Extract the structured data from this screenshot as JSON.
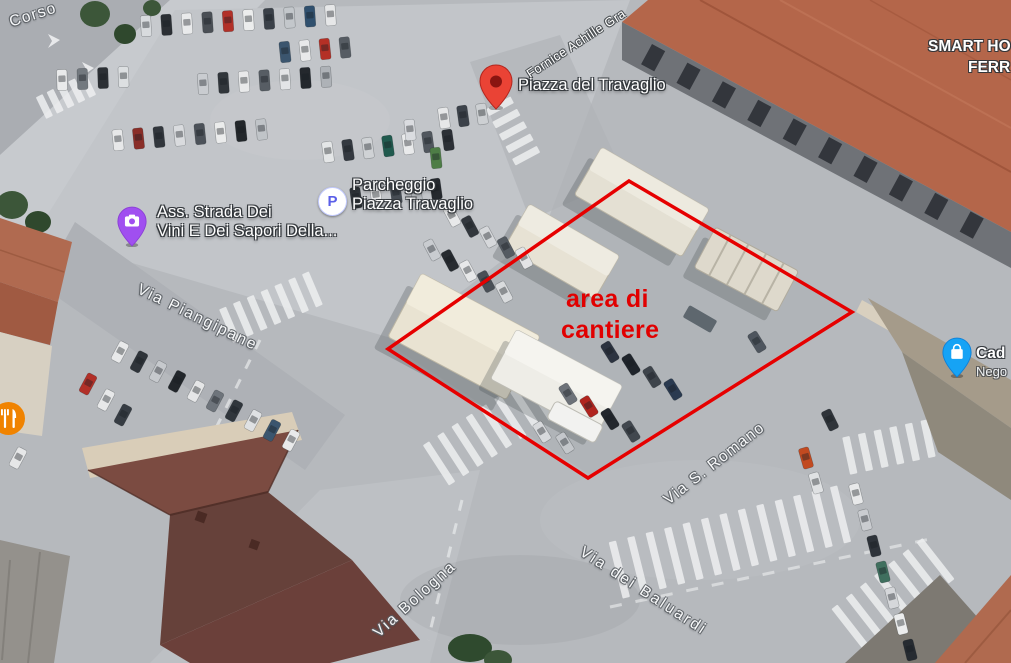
{
  "map_labels": {
    "piazza": {
      "name": "Piazza del Travaglio"
    },
    "parking": {
      "icon_letter": "P",
      "line1": "Parcheggio",
      "line2": "Piazza Travaglio"
    },
    "association": {
      "line1": "Ass. Strada Dei",
      "line2": "Vini E Dei Sapori Della..."
    },
    "hotel": {
      "line1": "SMART HO",
      "line2": "FERR"
    },
    "shop": {
      "line1": "Cad",
      "line2": "Nego"
    },
    "building_sign": "Fornice Achille Gra"
  },
  "street_labels": {
    "corso": "Corso",
    "piangipane": "Via Piangipane",
    "bologna": "Via Bologna",
    "baluardi": "Via dei Baluardi",
    "romano": "Via S. Romano"
  },
  "annotation": {
    "line1": "area di",
    "line2": "cantiere",
    "color": "#e60000"
  },
  "icons": {
    "pin_red": "#ea4335",
    "pin_red_dot": "#8a1511",
    "pin_purple": "#a04ff0",
    "pin_blue": "#16a3f5",
    "parking_p_color": "#5b5fe8",
    "restaurant_circle": "#f08300"
  }
}
